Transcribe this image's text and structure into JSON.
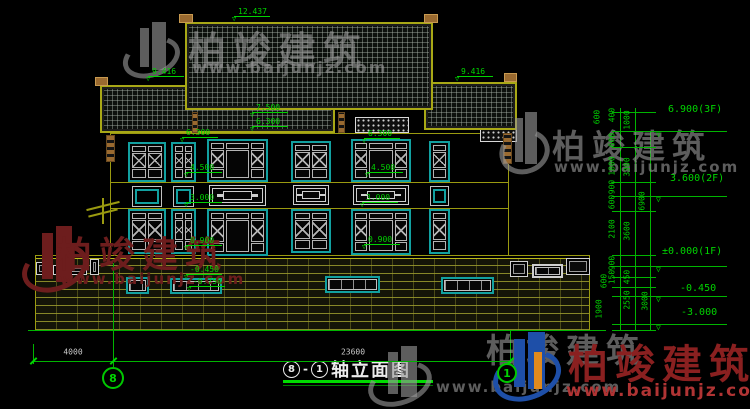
{
  "title": {
    "axis_from": "8",
    "sep": "-",
    "axis_to": "1",
    "text": "轴立面图"
  },
  "watermark": {
    "brand": "柏竣建筑",
    "url": "www.baijunjz.com"
  },
  "watermarks": [
    {
      "variant": "gray",
      "icon": {
        "x": 126,
        "y": 22,
        "w": 54,
        "h": 58
      },
      "t1": {
        "x": 188,
        "y": 20,
        "fs": 38
      },
      "t2": {
        "x": 192,
        "y": 58,
        "fs": 16
      }
    },
    {
      "variant": "gray",
      "icon": {
        "x": 503,
        "y": 112,
        "w": 46,
        "h": 64
      },
      "t1": {
        "x": 552,
        "y": 120,
        "fs": 33
      },
      "t2": {
        "x": 554,
        "y": 158,
        "fs": 15
      }
    },
    {
      "variant": "maroon",
      "icon": {
        "x": 26,
        "y": 226,
        "w": 62,
        "h": 68
      },
      "t1": {
        "x": 56,
        "y": 226,
        "fs": 36
      },
      "t2": {
        "x": 60,
        "y": 270,
        "fs": 15
      }
    },
    {
      "variant": "gray",
      "icon": {
        "x": 372,
        "y": 346,
        "w": 60,
        "h": 62
      },
      "t1": {
        "x": 486,
        "y": 324,
        "fs": 33
      },
      "t2": {
        "x": 436,
        "y": 378,
        "fs": 15
      }
    },
    {
      "variant": "color",
      "icon": {
        "x": 497,
        "y": 332,
        "w": 64,
        "h": 70
      },
      "t1": {
        "x": 568,
        "y": 332,
        "fs": 40
      },
      "t2": {
        "x": 566,
        "y": 381,
        "fs": 17
      }
    }
  ],
  "levels_small": [
    {
      "t": "12.437",
      "x": 238,
      "y": 7
    },
    {
      "t": "9.416",
      "x": 152,
      "y": 67
    },
    {
      "t": "9.416",
      "x": 461,
      "y": 67
    },
    {
      "t": "7.500",
      "x": 256,
      "y": 103
    },
    {
      "t": "6.300",
      "x": 256,
      "y": 117
    },
    {
      "t": "6.300",
      "x": 186,
      "y": 128
    },
    {
      "t": "4.500",
      "x": 190,
      "y": 163
    },
    {
      "t": "3.000",
      "x": 190,
      "y": 193
    },
    {
      "t": "0.900",
      "x": 190,
      "y": 236
    },
    {
      "t": "6.300",
      "x": 368,
      "y": 129
    },
    {
      "t": "4.500",
      "x": 371,
      "y": 163
    },
    {
      "t": "3.000",
      "x": 366,
      "y": 193
    },
    {
      "t": "0.900",
      "x": 368,
      "y": 235
    },
    {
      "t": "-0.450",
      "x": 190,
      "y": 265
    },
    {
      "t": "-0.750",
      "x": 193,
      "y": 277
    }
  ],
  "levels_right": [
    {
      "t": "6.900(3F)",
      "x": 668,
      "y": 105,
      "ly": 131
    },
    {
      "t": "3.600(2F)",
      "x": 670,
      "y": 174,
      "ly": 196
    },
    {
      "t": "±0.000(1F)",
      "x": 662,
      "y": 247,
      "ly": 266
    },
    {
      "t": "-0.450",
      "x": 680,
      "y": 284,
      "ly": 296
    },
    {
      "t": "-3.000",
      "x": 681,
      "y": 308,
      "ly": 324
    }
  ],
  "dims_rot": [
    {
      "t": "600",
      "x": 597,
      "y": 117
    },
    {
      "t": "400",
      "x": 612,
      "y": 115
    },
    {
      "t": "1000",
      "x": 627,
      "y": 120
    },
    {
      "t": "600",
      "x": 612,
      "y": 140
    },
    {
      "t": "1800",
      "x": 612,
      "y": 166
    },
    {
      "t": "3300",
      "x": 627,
      "y": 167
    },
    {
      "t": "900",
      "x": 612,
      "y": 187
    },
    {
      "t": "600",
      "x": 612,
      "y": 202
    },
    {
      "t": "6900",
      "x": 642,
      "y": 201
    },
    {
      "t": "2100",
      "x": 612,
      "y": 229
    },
    {
      "t": "3600",
      "x": 627,
      "y": 231
    },
    {
      "t": "900",
      "x": 612,
      "y": 263
    },
    {
      "t": "150",
      "x": 612,
      "y": 277
    },
    {
      "t": "600",
      "x": 604,
      "y": 281
    },
    {
      "t": "450",
      "x": 627,
      "y": 277
    },
    {
      "t": "2550",
      "x": 627,
      "y": 300
    },
    {
      "t": "3000",
      "x": 645,
      "y": 301
    },
    {
      "t": "1900",
      "x": 599,
      "y": 309
    }
  ],
  "dims_h": [
    {
      "t": "4000",
      "x": 73,
      "y": 352
    },
    {
      "t": "23600",
      "x": 353,
      "y": 352
    }
  ],
  "axis_bubbles": [
    {
      "n": "8",
      "cx": 113,
      "cy": 378,
      "r": 11
    },
    {
      "n": "1",
      "cx": 507,
      "cy": 373,
      "r": 10
    }
  ],
  "geometry": {
    "roofs": [
      {
        "x": 100,
        "y": 85,
        "w": 235,
        "h": 48
      },
      {
        "x": 424,
        "y": 82,
        "w": 93,
        "h": 48
      },
      {
        "x": 185,
        "y": 22,
        "w": 248,
        "h": 88
      }
    ],
    "finials": [
      {
        "x": 179,
        "y": 14,
        "w": 14,
        "h": 9
      },
      {
        "x": 424,
        "y": 14,
        "w": 14,
        "h": 9
      },
      {
        "x": 95,
        "y": 77,
        "w": 13,
        "h": 9
      },
      {
        "x": 504,
        "y": 73,
        "w": 13,
        "h": 9
      }
    ],
    "posts": [
      {
        "x": 106,
        "y": 135,
        "w": 9,
        "h": 27
      },
      {
        "x": 503,
        "y": 133,
        "w": 9,
        "h": 31
      },
      {
        "x": 338,
        "y": 112,
        "w": 7,
        "h": 21
      },
      {
        "x": 192,
        "y": 112,
        "w": 6,
        "h": 21
      }
    ],
    "lattice": [
      {
        "x": 211,
        "y": 118,
        "w": 52,
        "h": 15
      },
      {
        "x": 288,
        "y": 120,
        "w": 42,
        "h": 13
      },
      {
        "x": 355,
        "y": 117,
        "w": 54,
        "h": 16
      },
      {
        "x": 480,
        "y": 129,
        "w": 37,
        "h": 13
      }
    ],
    "windows": [
      {
        "x": 128,
        "y": 142,
        "w": 38,
        "h": 40,
        "k": "xwin"
      },
      {
        "x": 132,
        "y": 186,
        "w": 30,
        "h": 21,
        "k": "small"
      },
      {
        "x": 128,
        "y": 209,
        "w": 38,
        "h": 45,
        "k": "xwin"
      },
      {
        "x": 171,
        "y": 142,
        "w": 25,
        "h": 40,
        "k": "xwin"
      },
      {
        "x": 173,
        "y": 186,
        "w": 21,
        "h": 21,
        "k": "small"
      },
      {
        "x": 171,
        "y": 209,
        "w": 25,
        "h": 45,
        "k": "xwin"
      },
      {
        "x": 207,
        "y": 139,
        "w": 61,
        "h": 43,
        "k": "wide"
      },
      {
        "x": 209,
        "y": 185,
        "w": 57,
        "h": 21,
        "k": "panel"
      },
      {
        "x": 207,
        "y": 209,
        "w": 61,
        "h": 47,
        "k": "wide"
      },
      {
        "x": 291,
        "y": 141,
        "w": 40,
        "h": 41,
        "k": "xwin"
      },
      {
        "x": 293,
        "y": 185,
        "w": 36,
        "h": 20,
        "k": "panel"
      },
      {
        "x": 291,
        "y": 209,
        "w": 40,
        "h": 44,
        "k": "xwin"
      },
      {
        "x": 351,
        "y": 139,
        "w": 60,
        "h": 43,
        "k": "wide"
      },
      {
        "x": 353,
        "y": 185,
        "w": 56,
        "h": 20,
        "k": "panel"
      },
      {
        "x": 351,
        "y": 209,
        "w": 60,
        "h": 46,
        "k": "wide"
      },
      {
        "x": 429,
        "y": 141,
        "w": 21,
        "h": 41,
        "k": "xwin1"
      },
      {
        "x": 430,
        "y": 186,
        "w": 19,
        "h": 20,
        "k": "small"
      },
      {
        "x": 429,
        "y": 209,
        "w": 21,
        "h": 45,
        "k": "xwin1"
      }
    ],
    "basement_windows": [
      {
        "x": 126,
        "y": 277,
        "w": 23,
        "h": 17,
        "white": false
      },
      {
        "x": 170,
        "y": 278,
        "w": 52,
        "h": 16,
        "white": false
      },
      {
        "x": 325,
        "y": 276,
        "w": 55,
        "h": 17,
        "white": false
      },
      {
        "x": 441,
        "y": 277,
        "w": 53,
        "h": 17,
        "white": false
      },
      {
        "x": 532,
        "y": 264,
        "w": 31,
        "h": 14,
        "white": true
      }
    ],
    "balusters": [
      {
        "x": 36,
        "y": 262,
        "w": 13,
        "h": 13
      },
      {
        "x": 53,
        "y": 265,
        "w": 34,
        "h": 10
      },
      {
        "x": 90,
        "y": 259,
        "w": 9,
        "h": 16
      },
      {
        "x": 510,
        "y": 261,
        "w": 18,
        "h": 16
      },
      {
        "x": 566,
        "y": 258,
        "w": 24,
        "h": 17
      }
    ],
    "brick": {
      "x": 35,
      "y": 258,
      "w": 555,
      "h": 72
    },
    "hlines": [
      {
        "x": 110,
        "y": 133,
        "w": 398,
        "c": "olive"
      },
      {
        "x": 110,
        "y": 182,
        "w": 398,
        "c": "olive"
      },
      {
        "x": 110,
        "y": 208,
        "w": 398,
        "c": "olive"
      },
      {
        "x": 35,
        "y": 255,
        "w": 555,
        "c": "olive"
      },
      {
        "x": 28,
        "y": 330,
        "w": 578,
        "c": "green"
      }
    ],
    "vlines": [
      {
        "x": 110,
        "y": 133,
        "h": 123,
        "c": "olive"
      },
      {
        "x": 508,
        "y": 133,
        "h": 123,
        "c": "olive"
      },
      {
        "x": 35,
        "y": 255,
        "h": 75,
        "c": "olive"
      },
      {
        "x": 589,
        "y": 255,
        "h": 75,
        "c": "olive"
      },
      {
        "x": 113,
        "y": 263,
        "h": 104,
        "c": "green"
      },
      {
        "x": 510,
        "y": 330,
        "h": 33,
        "c": "green"
      },
      {
        "x": 33,
        "y": 344,
        "h": 20,
        "c": "green"
      },
      {
        "x": 620,
        "y": 108,
        "h": 222,
        "c": "green"
      },
      {
        "x": 635,
        "y": 108,
        "h": 222,
        "c": "green"
      },
      {
        "x": 650,
        "y": 131,
        "h": 199,
        "c": "green"
      }
    ],
    "rticks": [
      112,
      131,
      147,
      182,
      196,
      211,
      255,
      266,
      277,
      287,
      296,
      324,
      330
    ],
    "bottom_dim": {
      "x": 33,
      "y": 361,
      "w": 477,
      "ticks": [
        33,
        113,
        510
      ]
    },
    "canopy": {
      "x": 86,
      "y": 198
    }
  },
  "colors": {
    "dim_green": "#00c800",
    "olive": "#9a9a10",
    "teal": "#12a0a0",
    "white": "#cfcfcf",
    "brown": "#9a6a30",
    "wm_gray": "rgba(150,150,150,0.62)",
    "wm_maroon": "#6d1d1d",
    "wm_red_text": "#8a2020",
    "wm_red_url": "#b03434",
    "logo_blue": "#1e4fa8",
    "logo_orange": "#e08a1e"
  }
}
